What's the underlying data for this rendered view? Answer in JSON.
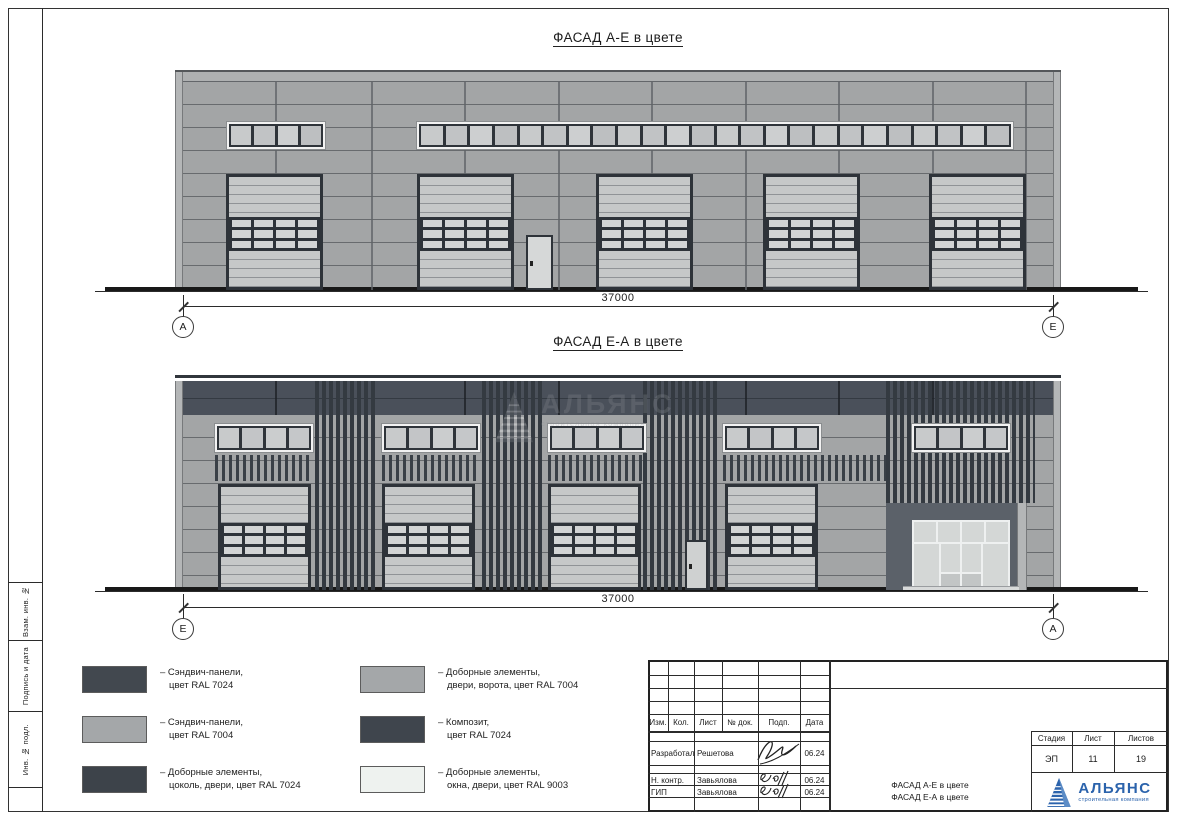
{
  "sheet": {
    "titles": {
      "facade1": "ФАСАД А-Е в цвете",
      "facade2": "ФАСАД Е-А в цвете"
    },
    "dimensions": {
      "facade1": "37000",
      "facade2": "37000"
    },
    "axes": {
      "facade1_left": "А",
      "facade1_right": "Е",
      "facade2_left": "Е",
      "facade2_right": "А"
    }
  },
  "stamp_sidebar": {
    "labels": [
      "Взам. инв. №",
      "Подпись и дата",
      "Инв. № подл."
    ]
  },
  "legend": {
    "items": [
      {
        "color": "#42484f",
        "line1": "– Сэндвич-панели,",
        "line2": "цвет RAL 7024"
      },
      {
        "color": "#a4a7a9",
        "line1": "– Сэндвич-панели,",
        "line2": "цвет RAL 7004"
      },
      {
        "color": "#3d434a",
        "line1": "– Доборные элементы,",
        "line2": "цоколь, двери, цвет RAL 7024"
      },
      {
        "color": "#a4a7a9",
        "line1": "– Доборные элементы,",
        "line2": "двери, ворота, цвет RAL 7004"
      },
      {
        "color": "#3f454d",
        "line1": "– Композит,",
        "line2": "цвет RAL 7024"
      },
      {
        "color": "#eef2ef",
        "line1": "– Доборные элементы,",
        "line2": "окна, двери, цвет RAL 9003"
      }
    ]
  },
  "title_block": {
    "header_cells": [
      "Изм.",
      "Кол.",
      "Лист",
      "№ док.",
      "Подп.",
      "Дата"
    ],
    "rows": [
      {
        "role": "Разработал",
        "name": "Решетова",
        "date": "06.24"
      },
      {
        "role": "Н. контр.",
        "name": "Завьялова",
        "date": "06.24"
      },
      {
        "role": "ГИП",
        "name": "Завьялова",
        "date": "06.24"
      }
    ],
    "stage_header": [
      "Стадия",
      "Лист",
      "Листов"
    ],
    "stage_values": [
      "ЭП",
      "11",
      "19"
    ],
    "doc_title_line1": "ФАСАД А-Е в цвете",
    "doc_title_line2": "ФАСАД Е-А в цвете",
    "company": {
      "name": "АЛЬЯНС",
      "tagline": "строительная компания"
    }
  },
  "watermark": {
    "name": "АЛЬЯНС",
    "tagline": "строительная компания"
  },
  "colors": {
    "ral7024": "#42484f",
    "ral7004": "#a4a7a9",
    "ral9003": "#eef2ef",
    "wall": "#a3a5a6",
    "dark_band": "#4a505a",
    "logo_blue": "#2b63ac"
  },
  "drawing": {
    "facade1": {
      "x": 175,
      "y": 70,
      "w": 886,
      "h": 218,
      "seams": [
        100,
        196,
        289,
        383,
        476,
        570,
        663,
        757,
        850
      ],
      "window_bands": [
        {
          "x": 52,
          "y": 50,
          "w": 98,
          "h": 27,
          "panes": 4
        },
        {
          "x": 242,
          "y": 50,
          "w": 596,
          "h": 27,
          "panes": 24
        }
      ],
      "doors_x": [
        51,
        242,
        421,
        588,
        754
      ],
      "door": {
        "y": 102,
        "w": 97,
        "h": 116
      },
      "man_door": {
        "x": 351,
        "y": 163,
        "w": 27,
        "h": 55
      }
    },
    "facade2": {
      "x": 175,
      "y": 375,
      "w": 886,
      "h": 212,
      "dark_band": {
        "y": 3,
        "h": 34
      },
      "seams": [
        100,
        196,
        289,
        383,
        476,
        570,
        663,
        757
      ],
      "pilasters": [
        {
          "x": 140,
          "w": 63,
          "y": 3,
          "h": 209
        },
        {
          "x": 307,
          "w": 63,
          "y": 3,
          "h": 209
        },
        {
          "x": 468,
          "w": 77,
          "y": 3,
          "h": 209
        },
        {
          "x": 711,
          "w": 149,
          "y": 3,
          "h": 122
        }
      ],
      "combs": [
        {
          "x": 40,
          "w": 98
        },
        {
          "x": 207,
          "w": 98
        },
        {
          "x": 373,
          "w": 98
        },
        {
          "x": 548,
          "w": 163
        }
      ],
      "comb_y": 77,
      "comb_h": 26,
      "window_bands": [
        {
          "x": 40,
          "y": 46,
          "w": 98,
          "h": 28,
          "panes": 4
        },
        {
          "x": 207,
          "y": 46,
          "w": 98,
          "h": 28,
          "panes": 4
        },
        {
          "x": 373,
          "y": 46,
          "w": 98,
          "h": 28,
          "panes": 4
        },
        {
          "x": 548,
          "y": 46,
          "w": 98,
          "h": 28,
          "panes": 4
        },
        {
          "x": 737,
          "y": 46,
          "w": 98,
          "h": 28,
          "panes": 4
        }
      ],
      "doors_x": [
        43,
        207,
        373,
        550
      ],
      "door": {
        "y": 106,
        "w": 93,
        "h": 106
      },
      "man_door": {
        "x": 510,
        "y": 162,
        "w": 23,
        "h": 50
      },
      "entrance": {
        "x": 711,
        "y": 125,
        "w": 131,
        "h": 87
      },
      "storefront": {
        "x": 737,
        "y": 142,
        "w": 98,
        "h": 68
      }
    }
  }
}
